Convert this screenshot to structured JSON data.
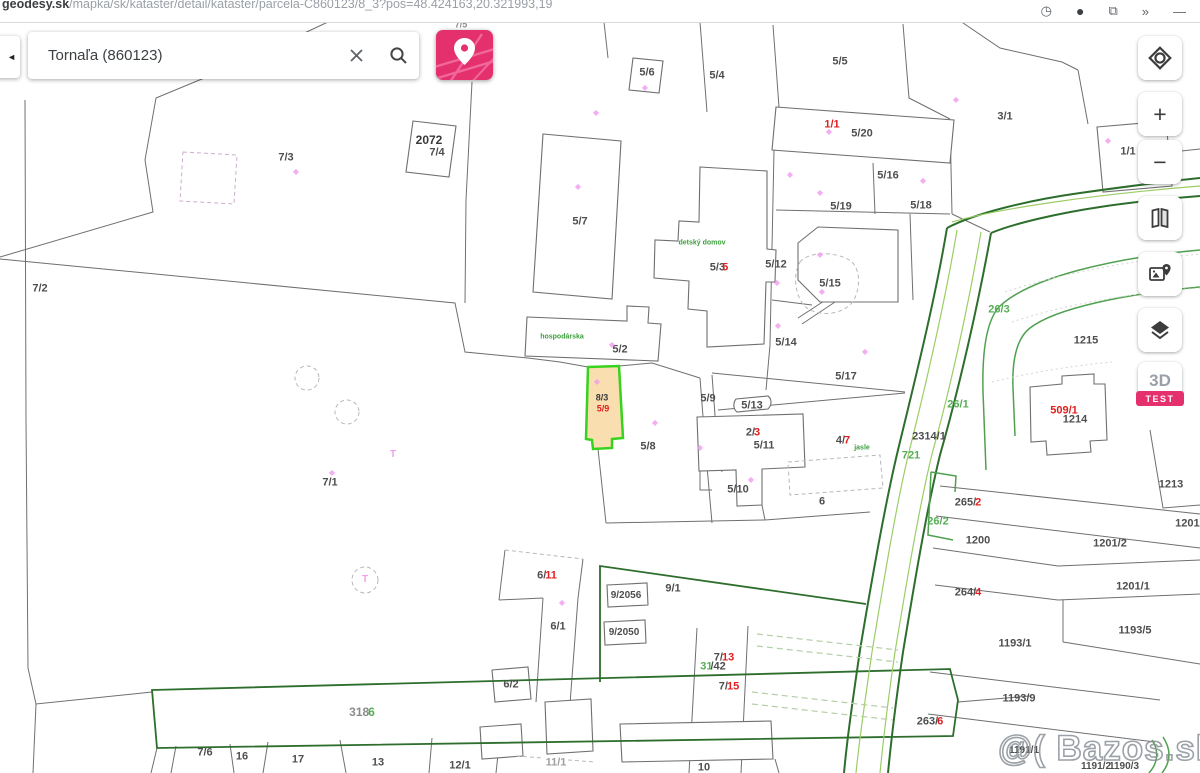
{
  "browser": {
    "domain": "geodesy.sk",
    "path": "/mapka/sk/kataster/detail/kataster/parcela-C860123/8_3?pos=48.424163,20.321993,19",
    "icons": [
      {
        "name": "clock-icon",
        "glyph": "◷"
      },
      {
        "name": "profile-icon",
        "glyph": "●"
      },
      {
        "name": "share-icon",
        "glyph": "⧉"
      },
      {
        "name": "extensions-overflow-icon",
        "glyph": "»"
      },
      {
        "name": "minimize-icon",
        "glyph": "—"
      }
    ]
  },
  "search": {
    "value": "Tornaľa (860123)",
    "collapse_glyph": "◄"
  },
  "toolbar": {
    "zoom_in": "+",
    "zoom_out": "−",
    "three_d": "3D",
    "test_badge": "TEST"
  },
  "watermark": {
    "text": "@( Bazos.sk"
  },
  "map": {
    "selected_parcel": "8/3",
    "palette": {
      "dark": "#4e4e4e",
      "black": "#3a3a3a",
      "red": "#e02020",
      "green": "#56ad56",
      "dgreen": "#3c9e3c",
      "grey": "#8c8c8c",
      "faint": "#9f9f9f",
      "pink": "#f0a0ef"
    },
    "labels": [
      {
        "t": "7/2",
        "x": 40,
        "y": 289
      },
      {
        "t": "7/3",
        "x": 286,
        "y": 158
      },
      {
        "t": "2072",
        "x": 429,
        "y": 140,
        "s": 12,
        "c": "black"
      },
      {
        "t": "7/4",
        "x": 437,
        "y": 153
      },
      {
        "t": "7/5",
        "x": 461,
        "y": 25,
        "s": 9,
        "c": "grey"
      },
      {
        "t": "5/7",
        "x": 580,
        "y": 222
      },
      {
        "t": "5/6",
        "x": 647,
        "y": 73
      },
      {
        "t": "5/4",
        "x": 717,
        "y": 76
      },
      {
        "t": "5/5",
        "x": 840,
        "y": 62
      },
      {
        "t": "1/1",
        "x": 832,
        "y": 125,
        "c": "red"
      },
      {
        "t": "5/20",
        "x": 862,
        "y": 134
      },
      {
        "t": "3/1",
        "x": 1005,
        "y": 117
      },
      {
        "t": "1/1",
        "x": 1128,
        "y": 152
      },
      {
        "t": "5/16",
        "x": 888,
        "y": 176
      },
      {
        "t": "5/19",
        "x": 841,
        "y": 207
      },
      {
        "t": "5/18",
        "x": 921,
        "y": 206
      },
      {
        "t": "5/12",
        "x": 776,
        "y": 265
      },
      {
        "parts": [
          {
            "t": "5/3"
          },
          {
            "t": "5",
            "c": "red",
            "ml": -3
          }
        ],
        "x": 719,
        "y": 268
      },
      {
        "t": "detský domov",
        "x": 702,
        "y": 243,
        "s": 7,
        "c": "dgreen"
      },
      {
        "t": "5/14",
        "x": 786,
        "y": 343
      },
      {
        "t": "5/15",
        "x": 830,
        "y": 284
      },
      {
        "t": "5/17",
        "x": 846,
        "y": 377
      },
      {
        "t": "5/2",
        "x": 620,
        "y": 350
      },
      {
        "t": "hospodárska",
        "x": 562,
        "y": 337,
        "s": 7,
        "c": "dgreen"
      },
      {
        "t": "8/3",
        "x": 602,
        "y": 398,
        "s": 9,
        "c": "black"
      },
      {
        "t": "5/9",
        "x": 603,
        "y": 409,
        "s": 9,
        "c": "red"
      },
      {
        "t": "5/9",
        "x": 708,
        "y": 399
      },
      {
        "t": "5/13",
        "x": 752,
        "y": 406
      },
      {
        "parts": [
          {
            "t": "2/"
          },
          {
            "t": "3",
            "c": "red",
            "ml": -1
          }
        ],
        "x": 753,
        "y": 433
      },
      {
        "t": "5/11",
        "x": 764,
        "y": 446
      },
      {
        "parts": [
          {
            "t": "4/"
          },
          {
            "t": "7",
            "c": "red",
            "ml": -1
          }
        ],
        "x": 843,
        "y": 441
      },
      {
        "t": "jasle",
        "x": 862,
        "y": 448,
        "s": 7,
        "c": "dgreen"
      },
      {
        "t": "2314/1",
        "x": 929,
        "y": 437
      },
      {
        "t": "721",
        "x": 911,
        "y": 456,
        "c": "green"
      },
      {
        "t": "26/3",
        "x": 999,
        "y": 310,
        "c": "green"
      },
      {
        "t": "26/1",
        "x": 958,
        "y": 405,
        "c": "green"
      },
      {
        "t": "1215",
        "x": 1086,
        "y": 341
      },
      {
        "t": "509/1",
        "x": 1064,
        "y": 411,
        "c": "red"
      },
      {
        "t": "1214",
        "x": 1075,
        "y": 420
      },
      {
        "t": "1213",
        "x": 1171,
        "y": 485
      },
      {
        "parts": [
          {
            "t": "265/"
          },
          {
            "t": "2",
            "c": "red",
            "ml": -1
          }
        ],
        "x": 968,
        "y": 503
      },
      {
        "t": "26/2",
        "x": 938,
        "y": 522,
        "c": "green"
      },
      {
        "t": "1200",
        "x": 978,
        "y": 541
      },
      {
        "t": "1201/2",
        "x": 1110,
        "y": 544
      },
      {
        "t": "1201/1",
        "x": 1192,
        "y": 524
      },
      {
        "t": "1201/1",
        "x": 1133,
        "y": 587
      },
      {
        "parts": [
          {
            "t": "264/"
          },
          {
            "t": "4",
            "c": "red",
            "ml": -1
          }
        ],
        "x": 968,
        "y": 593
      },
      {
        "t": "1193/5",
        "x": 1135,
        "y": 631
      },
      {
        "t": "1193/1",
        "x": 1015,
        "y": 644
      },
      {
        "t": "1193/9",
        "x": 1019,
        "y": 699
      },
      {
        "parts": [
          {
            "t": "263/"
          },
          {
            "t": "6",
            "c": "red",
            "ml": -1
          }
        ],
        "x": 930,
        "y": 722
      },
      {
        "t": "5/8",
        "x": 648,
        "y": 447
      },
      {
        "t": "5/10",
        "x": 738,
        "y": 490
      },
      {
        "t": "6",
        "x": 822,
        "y": 502
      },
      {
        "parts": [
          {
            "t": "6/"
          },
          {
            "t": "11",
            "c": "red",
            "ml": -1
          }
        ],
        "x": 547,
        "y": 576
      },
      {
        "t": "9/1",
        "x": 673,
        "y": 589
      },
      {
        "t": "9/2056",
        "x": 626,
        "y": 596,
        "s": 10
      },
      {
        "t": "9/2050",
        "x": 624,
        "y": 633,
        "s": 10
      },
      {
        "t": "6/1",
        "x": 558,
        "y": 627
      },
      {
        "t": "6/2",
        "x": 511,
        "y": 685
      },
      {
        "parts": [
          {
            "t": "7/"
          },
          {
            "t": "13",
            "c": "red",
            "ml": -1
          }
        ],
        "x": 724,
        "y": 658
      },
      {
        "parts": [
          {
            "t": "31",
            "c": "green"
          },
          {
            "t": "/42",
            "ml": -2
          }
        ],
        "x": 713,
        "y": 667
      },
      {
        "parts": [
          {
            "t": "7/"
          },
          {
            "t": "15",
            "c": "red",
            "ml": -1
          }
        ],
        "x": 729,
        "y": 687
      },
      {
        "parts": [
          {
            "t": "318",
            "c": "grey"
          },
          {
            "t": "6",
            "c": "green",
            "ml": -1
          }
        ],
        "x": 362,
        "y": 712,
        "s": 12
      },
      {
        "t": "7/6",
        "x": 205,
        "y": 753
      },
      {
        "t": "16",
        "x": 242,
        "y": 757
      },
      {
        "t": "17",
        "x": 298,
        "y": 760
      },
      {
        "t": "13",
        "x": 378,
        "y": 763
      },
      {
        "t": "12/1",
        "x": 460,
        "y": 766
      },
      {
        "t": "11/1",
        "x": 556,
        "y": 763,
        "c": "faint"
      },
      {
        "t": "10",
        "x": 704,
        "y": 768
      },
      {
        "t": "7/1",
        "x": 330,
        "y": 483
      },
      {
        "t": "1191/1",
        "x": 1024,
        "y": 751,
        "s": 10
      },
      {
        "t": "1191/2",
        "x": 1096,
        "y": 767,
        "s": 10
      },
      {
        "t": "1190/3",
        "x": 1124,
        "y": 767,
        "s": 10
      }
    ],
    "symbols": {
      "diamond_glyph": "◆",
      "tree_glyph": "T",
      "diamonds": [
        [
          296,
          172
        ],
        [
          578,
          187
        ],
        [
          596,
          113
        ],
        [
          645,
          88
        ],
        [
          790,
          175
        ],
        [
          820,
          193
        ],
        [
          829,
          132
        ],
        [
          923,
          181
        ],
        [
          956,
          100
        ],
        [
          777,
          283
        ],
        [
          778,
          326
        ],
        [
          820,
          255
        ],
        [
          822,
          292
        ],
        [
          865,
          352
        ],
        [
          612,
          345
        ],
        [
          597,
          382
        ],
        [
          655,
          423
        ],
        [
          700,
          448
        ],
        [
          751,
          480
        ],
        [
          332,
          473
        ],
        [
          562,
          603
        ],
        [
          1108,
          141
        ]
      ],
      "tees": [
        [
          393,
          455
        ],
        [
          365,
          580
        ]
      ]
    }
  }
}
